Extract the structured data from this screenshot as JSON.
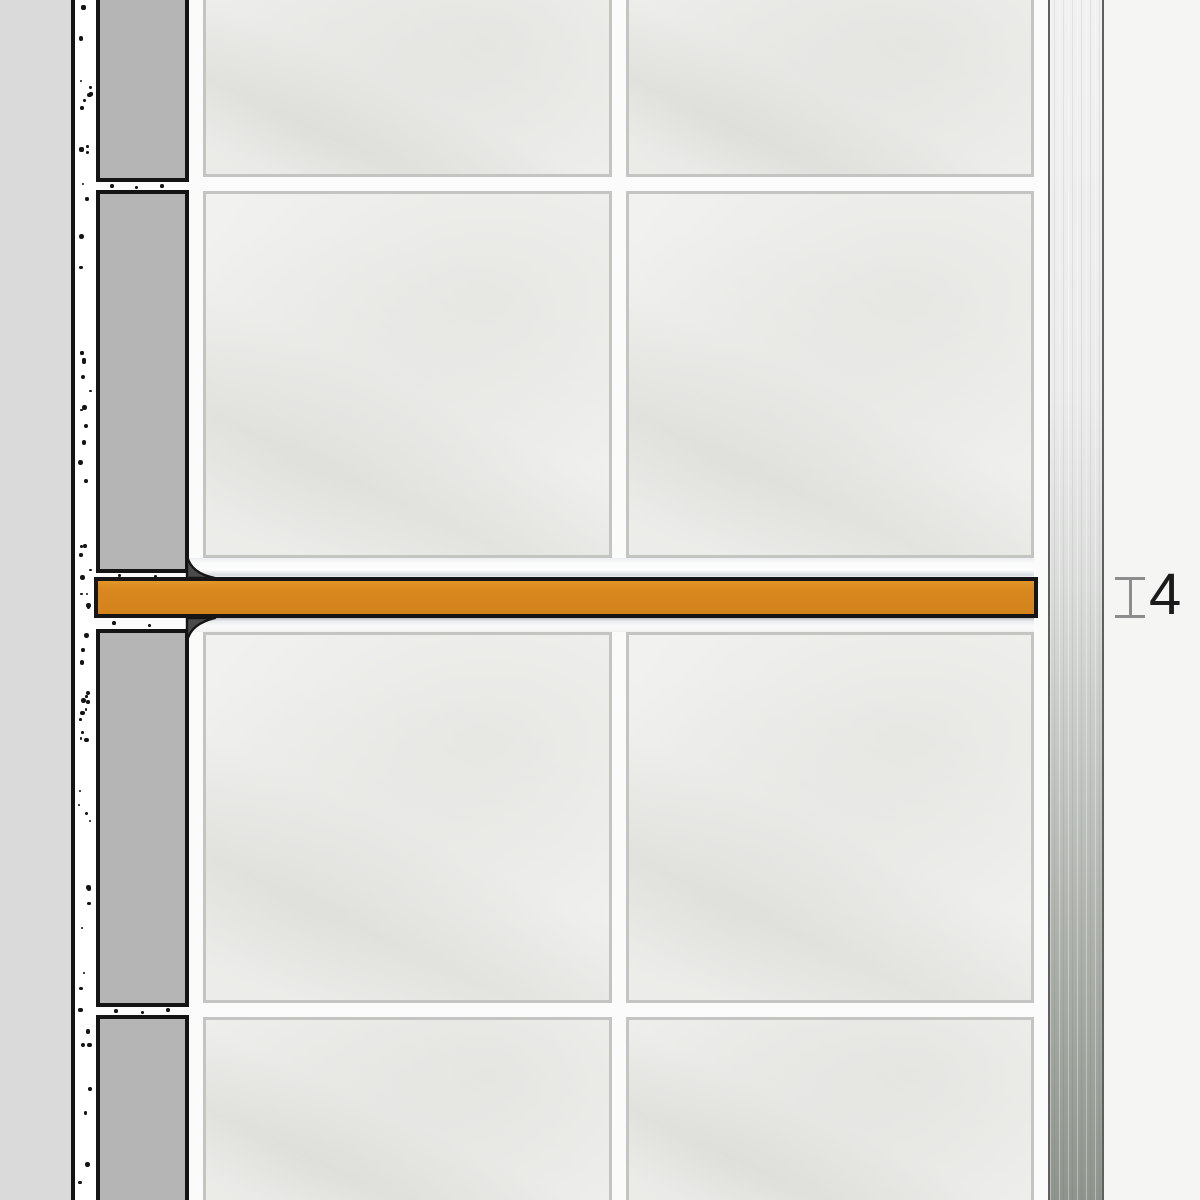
{
  "diagram": {
    "description": "Tiled wall cross-section with inserted decorative border profile and edge trim",
    "dimension": {
      "label": "4"
    },
    "colors": {
      "background": "#F5F5F4",
      "substrate": "#DADADA",
      "outline": "#141414",
      "adhesive_white": "#FFFFFF",
      "section_tile": "#B5B5B5",
      "grout_white": "#FBFBFB",
      "tile_face": "#F1F1EF",
      "tile_edge": "#C4C4C2",
      "flange_white": "#FAFAFA",
      "sealant": "#4B4B4B",
      "profile_fill": "#D9881F",
      "profile_outline": "#161616",
      "metal_light": "#F1F1F1",
      "metal_mid": "#C6C9C6",
      "metal_dark": "#8F948D",
      "metal_edge": "#5F5F5F",
      "marker": "#8D8D8D",
      "dimension_text": "#1B1B1B"
    }
  }
}
